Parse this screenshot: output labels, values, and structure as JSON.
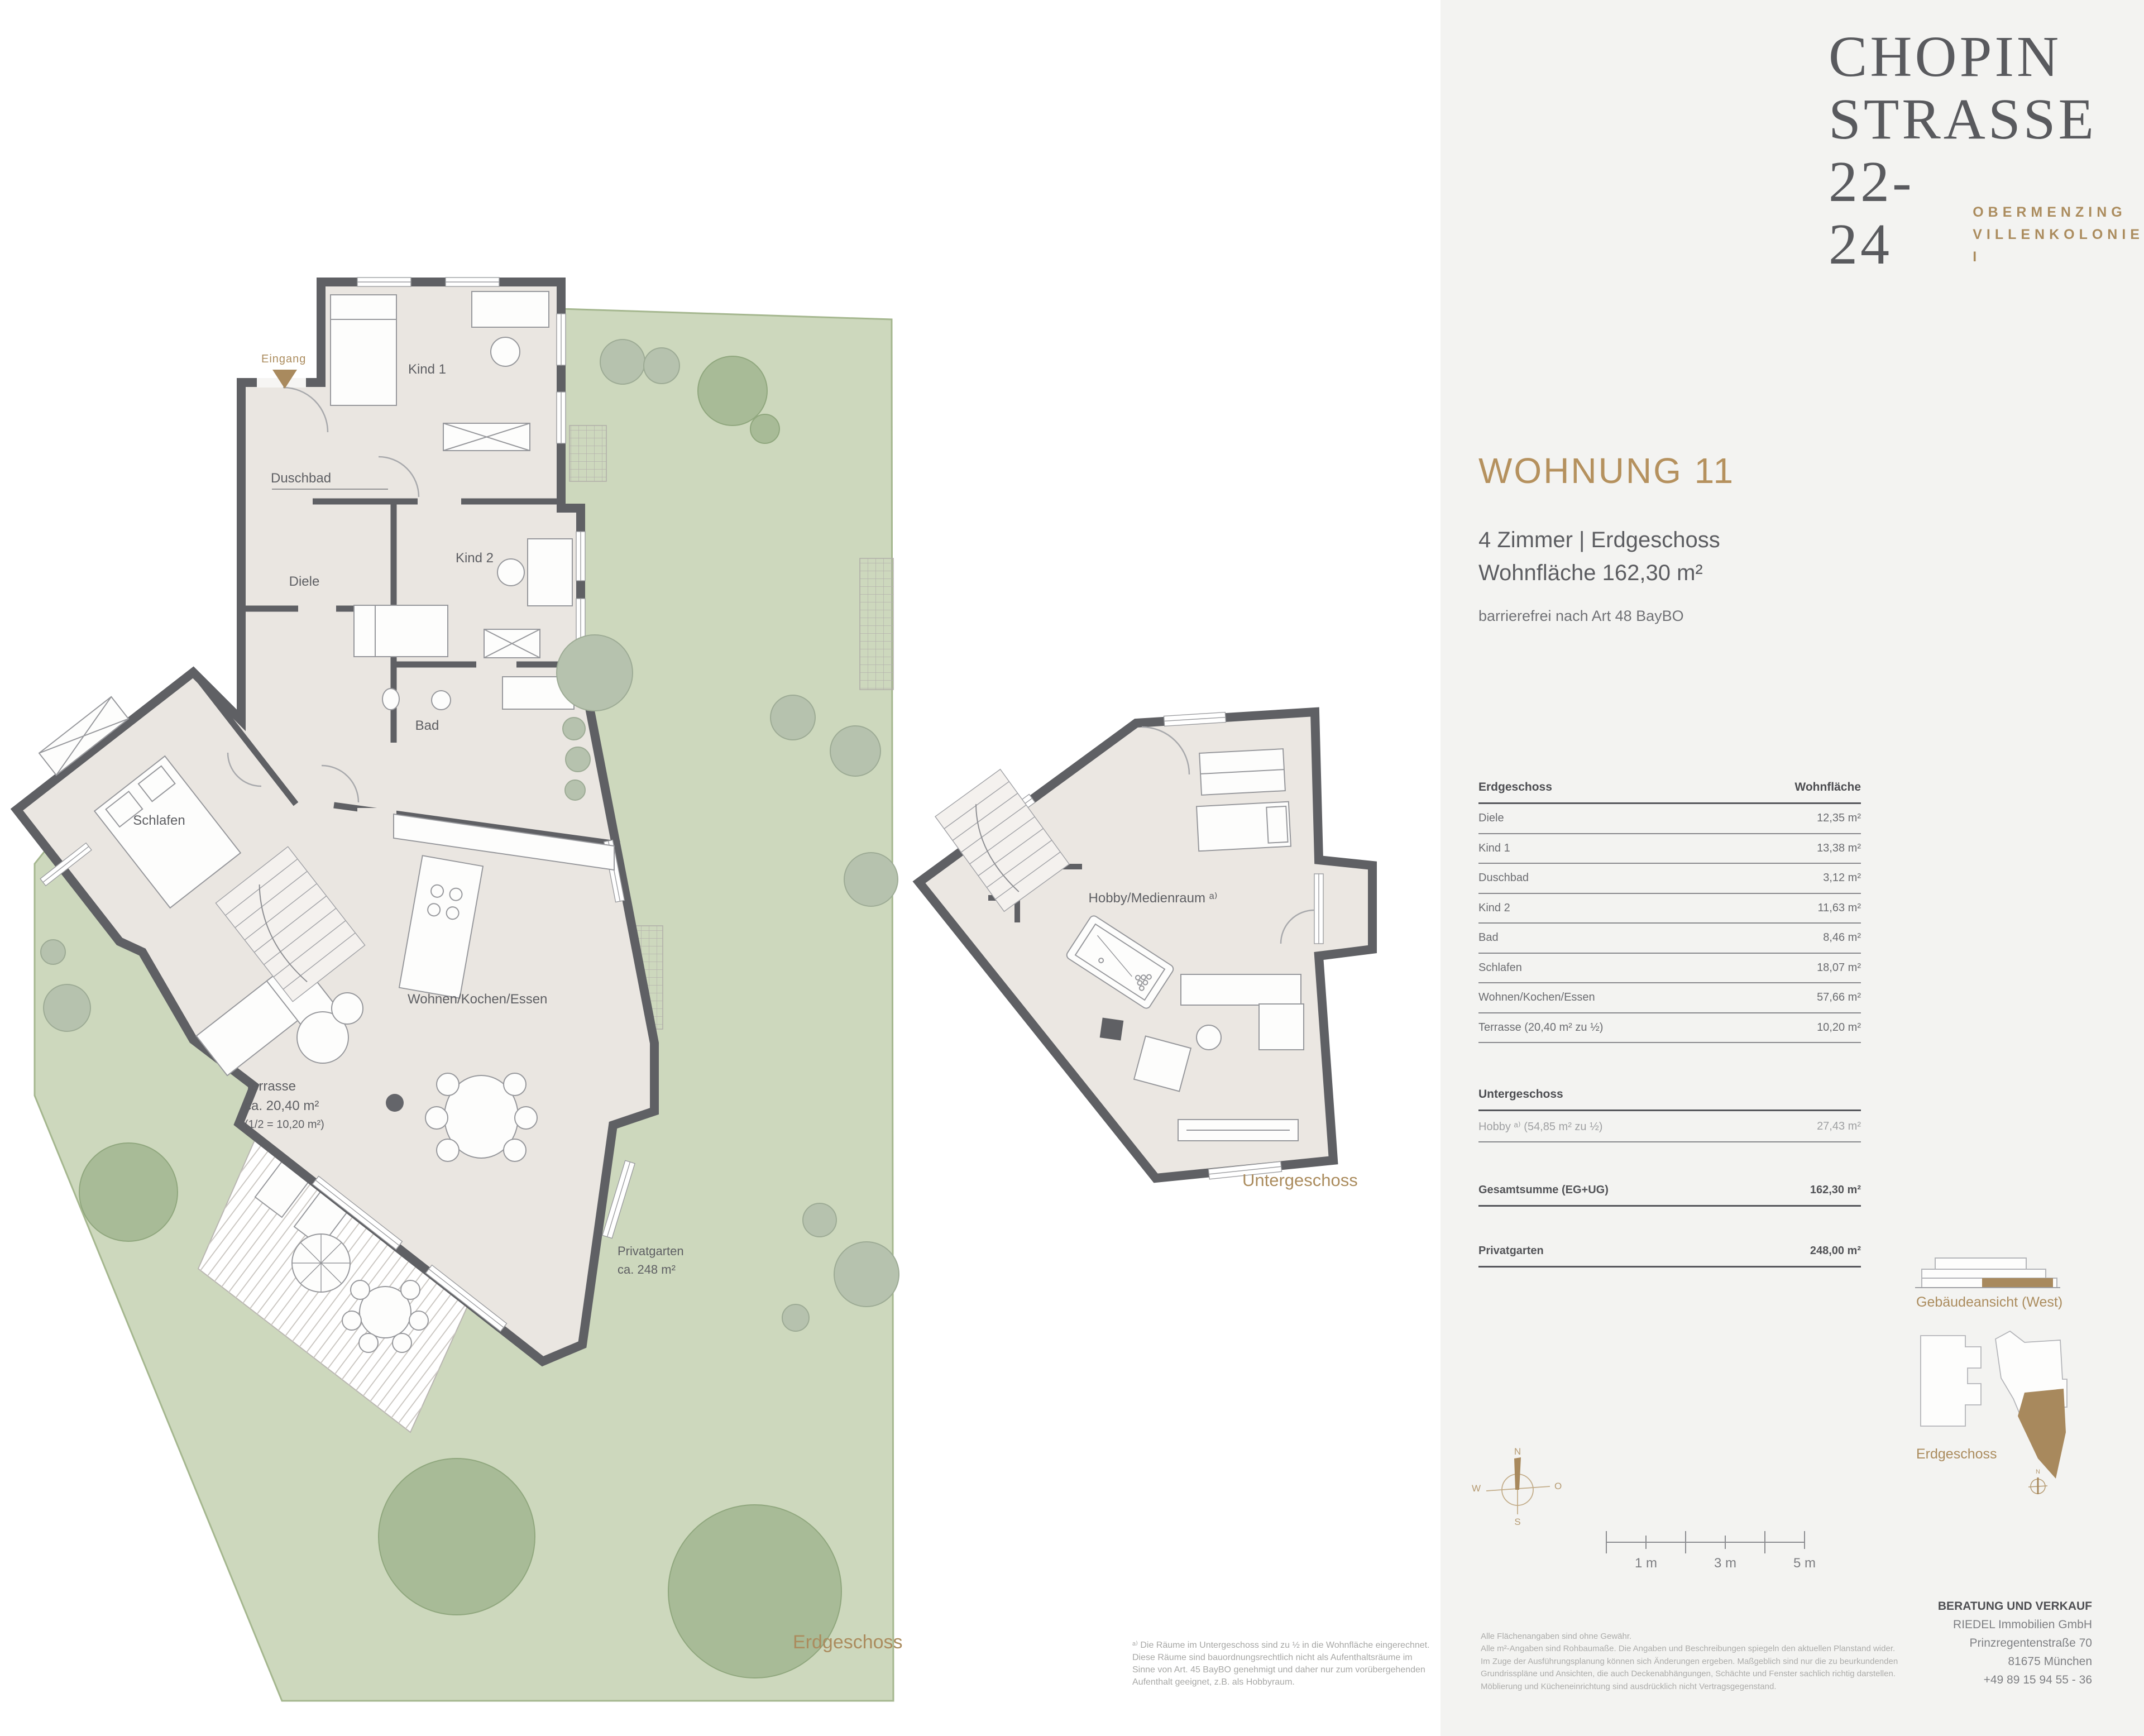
{
  "brand": {
    "name_line1": "CHOPIN",
    "name_line2": "STRASSE",
    "name_line3": "22-24",
    "tagline_line1": "OBERMENZING",
    "tagline_line2": "VILLENKOLONIE I"
  },
  "listing": {
    "title": "WOHNUNG 11",
    "rooms_floor": "4 Zimmer | Erdgeschoss",
    "living_area": "Wohnfläche 162,30 m²",
    "accessibility": "barrierefrei nach Art 48 BayBO"
  },
  "area_table": {
    "eg": {
      "col_room": "Erdgeschoss",
      "col_area": "Wohnfläche",
      "rows": [
        [
          "Diele",
          "12,35 m²"
        ],
        [
          "Kind 1",
          "13,38 m²"
        ],
        [
          "Duschbad",
          "3,12 m²"
        ],
        [
          "Kind 2",
          "11,63 m²"
        ],
        [
          "Bad",
          "8,46 m²"
        ],
        [
          "Schlafen",
          "18,07 m²"
        ],
        [
          "Wohnen/Kochen/Essen",
          "57,66 m²"
        ],
        [
          "Terrasse (20,40 m² zu ½)",
          "10,20 m²"
        ]
      ]
    },
    "ug": {
      "header": "Untergeschoss",
      "rows": [
        [
          "Hobby ᵃ⁾ (54,85 m² zu ½)",
          "27,43 m²"
        ]
      ]
    },
    "total": {
      "label": "Gesamtsumme (EG+UG)",
      "value": "162,30 m²"
    },
    "garden": {
      "label": "Privatgarten",
      "value": "248,00 m²"
    }
  },
  "plan_eg": {
    "caption": "Erdgeschoss",
    "entry": "Eingang",
    "rooms": {
      "kind1": "Kind 1",
      "duschbad": "Duschbad",
      "diele": "Diele",
      "kind2": "Kind 2",
      "bad": "Bad",
      "schlafen": "Schlafen",
      "wohnen": "Wohnen/Kochen/Essen"
    },
    "terrasse": {
      "l1": "Terrasse",
      "l2": "ca. 20,40 m²",
      "l3": "(1/2 = 10,20 m²)"
    },
    "garden": {
      "l1": "Privatgarten",
      "l2": "ca. 248 m²"
    }
  },
  "plan_ug": {
    "caption": "Untergeschoss",
    "room": "Hobby/Medienraum ᵃ⁾"
  },
  "scale_bar": {
    "m1": "1 m",
    "m3": "3 m",
    "m5": "5 m"
  },
  "compass": {
    "n": "N",
    "e": "O",
    "s": "S",
    "w": "W"
  },
  "sketches": {
    "elevation_caption": "Gebäudeansicht (West)",
    "siteplan_caption": "Erdgeschoss",
    "mini_compass_n": "N"
  },
  "contact": {
    "header": "BERATUNG UND VERKAUF",
    "company": "RIEDEL Immobilien GmbH",
    "street": "Prinzregentenstraße 70",
    "city": "81675 München",
    "phone": "+49 89 15 94 55 - 36"
  },
  "footnote": {
    "l1": "ᵃ⁾ Die Räume im Untergeschoss sind zu ½ in die Wohnfläche eingerechnet.",
    "l2": "Diese Räume sind bauordnungsrechtlich nicht als Aufenthaltsräume im",
    "l3": "Sinne von Art. 45 BayBO genehmigt und daher nur zum vorübergehenden",
    "l4": "Aufenthalt geeignet, z.B. als Hobbyraum."
  },
  "disclaimer": {
    "l1": "Alle Flächenangaben sind ohne Gewähr.",
    "l2": "Alle m²-Angaben sind Rohbaumaße. Die Angaben und Beschreibungen spiegeln den aktuellen Planstand wider.",
    "l3": "Im Zuge der Ausführungsplanung können sich Änderungen ergeben. Maßgeblich sind nur die zu beurkundenden",
    "l4": "Grundrisspläne und Ansichten, die auch Deckenabhängungen, Schächte und Fenster sachlich richtig darstellen.",
    "l5": "Möblierung und Kücheneinrichtung sind ausdrücklich nicht Vertragsgegenstand."
  },
  "colors": {
    "accent": "#ab8c5e",
    "text_dark": "#54555a",
    "wall": "#5f6064",
    "room_fill": "#eae6e1",
    "garden": "#cdd8bd"
  }
}
